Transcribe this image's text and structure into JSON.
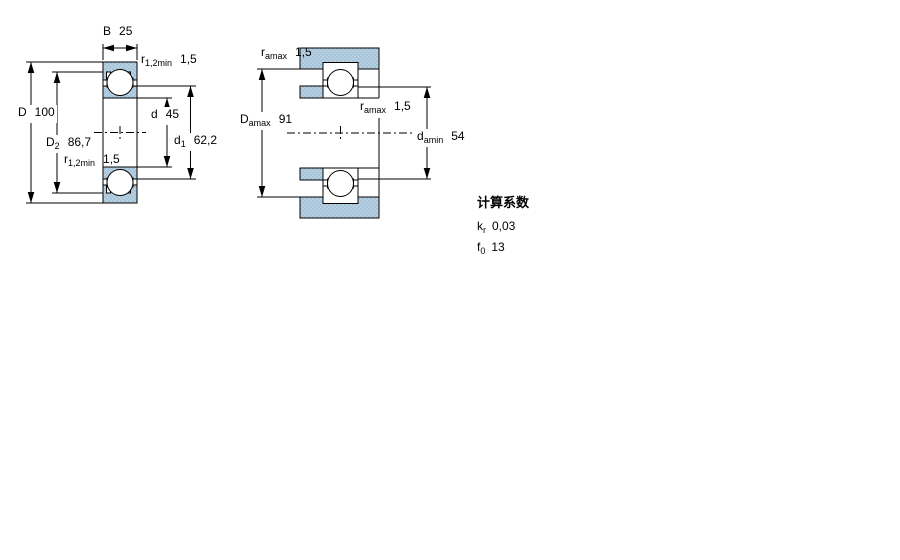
{
  "dims_left": {
    "B": {
      "sym": "B",
      "sub": "",
      "value": "25"
    },
    "r_top": {
      "sym": "r",
      "sub": "1,2min",
      "value": "1,5"
    },
    "D": {
      "sym": "D",
      "sub": "",
      "value": "100"
    },
    "D2": {
      "sym": "D",
      "sub": "2",
      "value": "86,7"
    },
    "d": {
      "sym": "d",
      "sub": "",
      "value": "45"
    },
    "d1": {
      "sym": "d",
      "sub": "1",
      "value": "62,2"
    },
    "r_bottom": {
      "sym": "r",
      "sub": "1,2min",
      "value": "1,5"
    }
  },
  "dims_right": {
    "r_housing": {
      "sym": "r",
      "sub": "amax",
      "value": "1,5"
    },
    "Da": {
      "sym": "D",
      "sub": "amax",
      "value": "91"
    },
    "r_shaft": {
      "sym": "r",
      "sub": "amax",
      "value": "1,5"
    },
    "da": {
      "sym": "d",
      "sub": "amin",
      "value": "54"
    }
  },
  "calculation_factors": {
    "title": "计算系数",
    "rows": [
      {
        "sym": "k",
        "sub": "r",
        "value": "0,03"
      },
      {
        "sym": "f",
        "sub": "0",
        "value": "13"
      }
    ]
  },
  "colors": {
    "section_fill": "#b6cfe1",
    "section_dot": "#8fb3cc",
    "line_color": "#000000"
  }
}
